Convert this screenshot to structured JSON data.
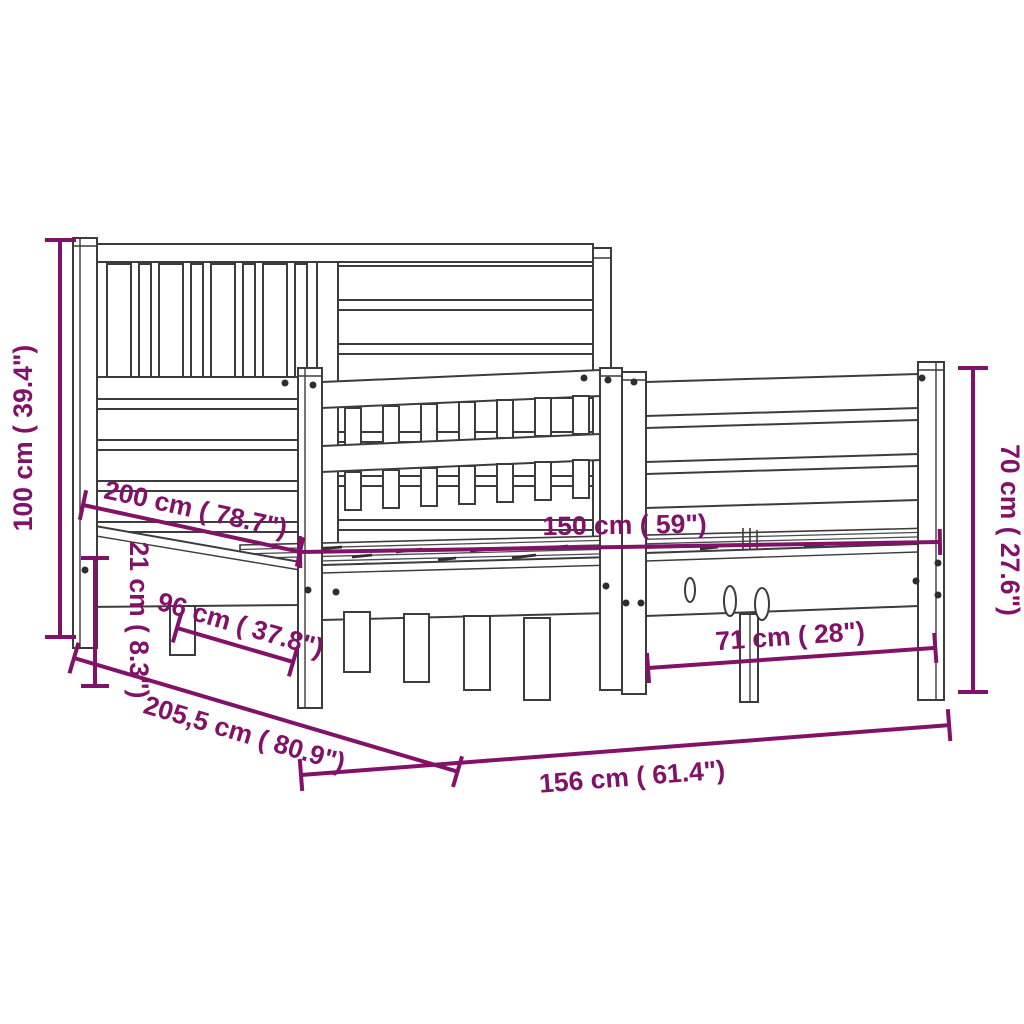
{
  "image": {
    "type": "product-dimension-diagram",
    "subject": "wooden bed frame with headboard and footboard, perspective line drawing",
    "background_color": "#ffffff",
    "drawing_line_color": "#3c3c3c",
    "dimension_color": "#821168"
  },
  "dimensions": {
    "headboard_height": "100 cm ( 39.4\")",
    "bed_length": "200 cm ( 78.7\")",
    "side_rail_height": "21 cm ( 8.3\")",
    "headboard_leg_section": "96 cm ( 37.8\")",
    "total_length": "205,5 cm ( 80.9\")",
    "inner_width": "150 cm ( 59\")",
    "footboard_height": "70 cm ( 27.6\")",
    "footboard_inner_width": "71 cm ( 28\")",
    "total_width": "156 cm ( 61.4\")"
  }
}
